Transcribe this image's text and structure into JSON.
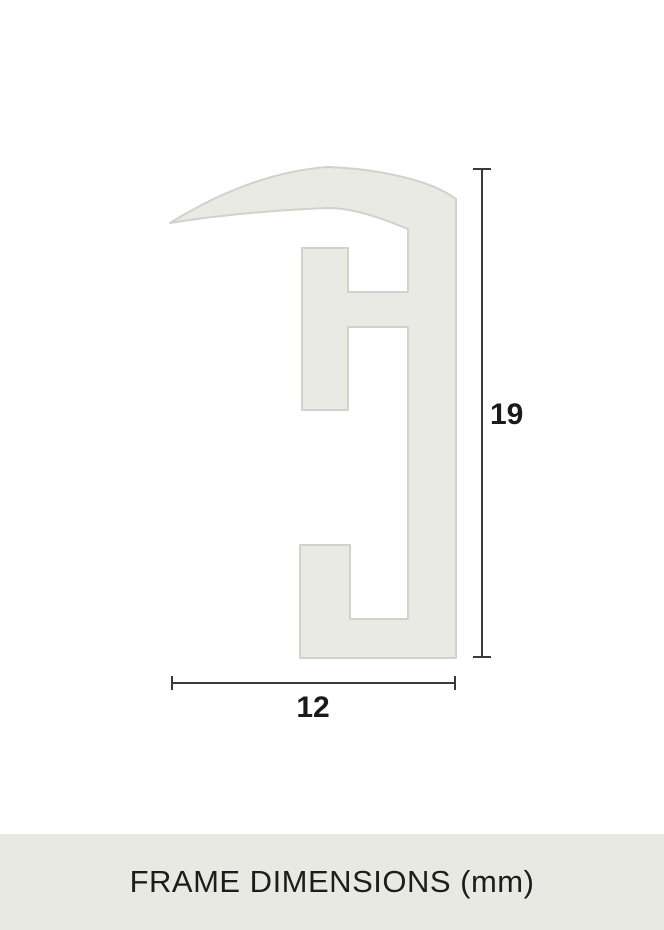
{
  "diagram": {
    "height_label": "19",
    "width_label": "12"
  },
  "footer": {
    "title": "FRAME DIMENSIONS (mm)"
  },
  "colors": {
    "background": "#ffffff",
    "profile_fill": "#eaeae5",
    "profile_stroke": "#d2d2cc",
    "dimension_line": "#3a3a3a",
    "label_text": "#1a1a1a",
    "footer_bg": "#e9e9e4",
    "footer_text": "#1d1d1b"
  }
}
